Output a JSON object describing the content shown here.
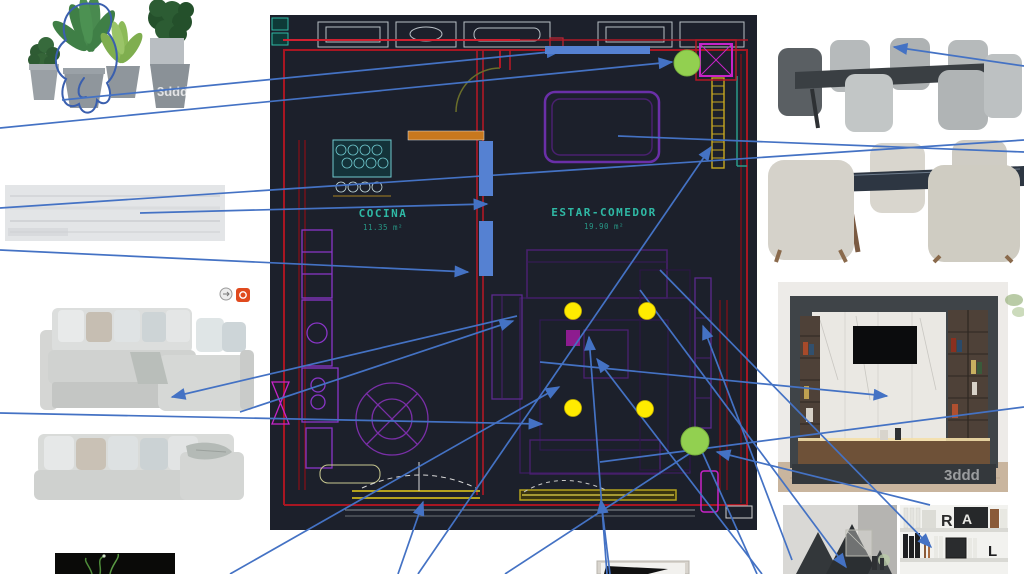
{
  "board": {
    "annotation_color": "#4472C4",
    "scribble_path": "M93,4 C72,0 58,20 66,40 C52,50 53,72 66,79 C57,96 66,112 79,104 C82,117 96,115 97,100 C106,109 115,98 107,83 C121,70 119,44 108,33 C117,15 106,1 93,4 Z M84,78 C76,88 77,100 86,97",
    "connectors": [
      {
        "x1": 62,
        "y1": 100,
        "x2": 560,
        "y2": 51,
        "arrow": true
      },
      {
        "x1": 0,
        "y1": 128,
        "x2": 672,
        "y2": 62,
        "arrow": true
      },
      {
        "x1": 140,
        "y1": 213,
        "x2": 487,
        "y2": 204,
        "arrow": true
      },
      {
        "x1": 0,
        "y1": 250,
        "x2": 468,
        "y2": 272,
        "arrow": true
      },
      {
        "x1": 240,
        "y1": 412,
        "x2": 513,
        "y2": 321,
        "arrow": true
      },
      {
        "x1": 517,
        "y1": 316,
        "x2": 172,
        "y2": 397,
        "arrow": true
      },
      {
        "x1": 1024,
        "y1": 66,
        "x2": 894,
        "y2": 47,
        "arrow": true
      },
      {
        "x1": 0,
        "y1": 208,
        "x2": 1024,
        "y2": 140,
        "arrow": false
      },
      {
        "x1": 0,
        "y1": 413,
        "x2": 542,
        "y2": 424,
        "arrow": true
      },
      {
        "x1": 230,
        "y1": 574,
        "x2": 559,
        "y2": 387,
        "arrow": true
      },
      {
        "x1": 418,
        "y1": 574,
        "x2": 711,
        "y2": 147,
        "arrow": true
      },
      {
        "x1": 398,
        "y1": 574,
        "x2": 423,
        "y2": 502,
        "arrow": true
      },
      {
        "x1": 610,
        "y1": 574,
        "x2": 601,
        "y2": 500,
        "arrow": true
      },
      {
        "x1": 607,
        "y1": 574,
        "x2": 589,
        "y2": 337,
        "arrow": true
      },
      {
        "x1": 762,
        "y1": 574,
        "x2": 597,
        "y2": 359,
        "arrow": true
      },
      {
        "x1": 540,
        "y1": 362,
        "x2": 887,
        "y2": 396,
        "arrow": true
      },
      {
        "x1": 640,
        "y1": 290,
        "x2": 846,
        "y2": 567,
        "arrow": true
      },
      {
        "x1": 660,
        "y1": 270,
        "x2": 931,
        "y2": 547,
        "arrow": true
      },
      {
        "x1": 792,
        "y1": 560,
        "x2": 703,
        "y2": 326,
        "arrow": true
      },
      {
        "x1": 930,
        "y1": 505,
        "x2": 717,
        "y2": 452,
        "arrow": true
      },
      {
        "x1": 700,
        "y1": 447,
        "x2": 757,
        "y2": 574,
        "arrow": false
      },
      {
        "x1": 600,
        "y1": 462,
        "x2": 1024,
        "y2": 407,
        "arrow": false
      },
      {
        "x1": 618,
        "y1": 136,
        "x2": 1024,
        "y2": 152,
        "arrow": false
      },
      {
        "x1": 505,
        "y1": 574,
        "x2": 695,
        "y2": 450,
        "arrow": false
      }
    ],
    "markers": {
      "yellow_color": "#FFEB00",
      "green_color": "#92D050",
      "bar_color": "#5581D2",
      "yellow_dots": [
        [
          573,
          311
        ],
        [
          647,
          311
        ],
        [
          573,
          408
        ],
        [
          645,
          409
        ]
      ],
      "green_circles": [
        [
          687,
          63,
          13
        ],
        [
          695,
          441,
          14
        ]
      ],
      "blue_bars": [
        [
          545,
          46,
          105,
          8
        ],
        [
          479,
          141,
          14,
          55
        ],
        [
          479,
          221,
          14,
          55
        ]
      ]
    }
  },
  "floorplan": {
    "rooms": [
      {
        "name": "COCINA",
        "area": "11.35 m²"
      },
      {
        "name": "ESTAR-COMEDOR",
        "area": "19.90 m²"
      }
    ],
    "colors": {
      "background": "#1C202B",
      "walls": "#A81622",
      "furniture": "#7A2FA8",
      "labels": "#2FB9A5",
      "windows": "#B4A21E",
      "highlight": "#C823C8"
    }
  },
  "images": {
    "plants": {
      "watermark": "3ddd"
    },
    "tv_unit": {
      "watermark": "3ddd"
    },
    "shelves": {
      "letters": [
        "R",
        "A",
        "L"
      ]
    }
  }
}
